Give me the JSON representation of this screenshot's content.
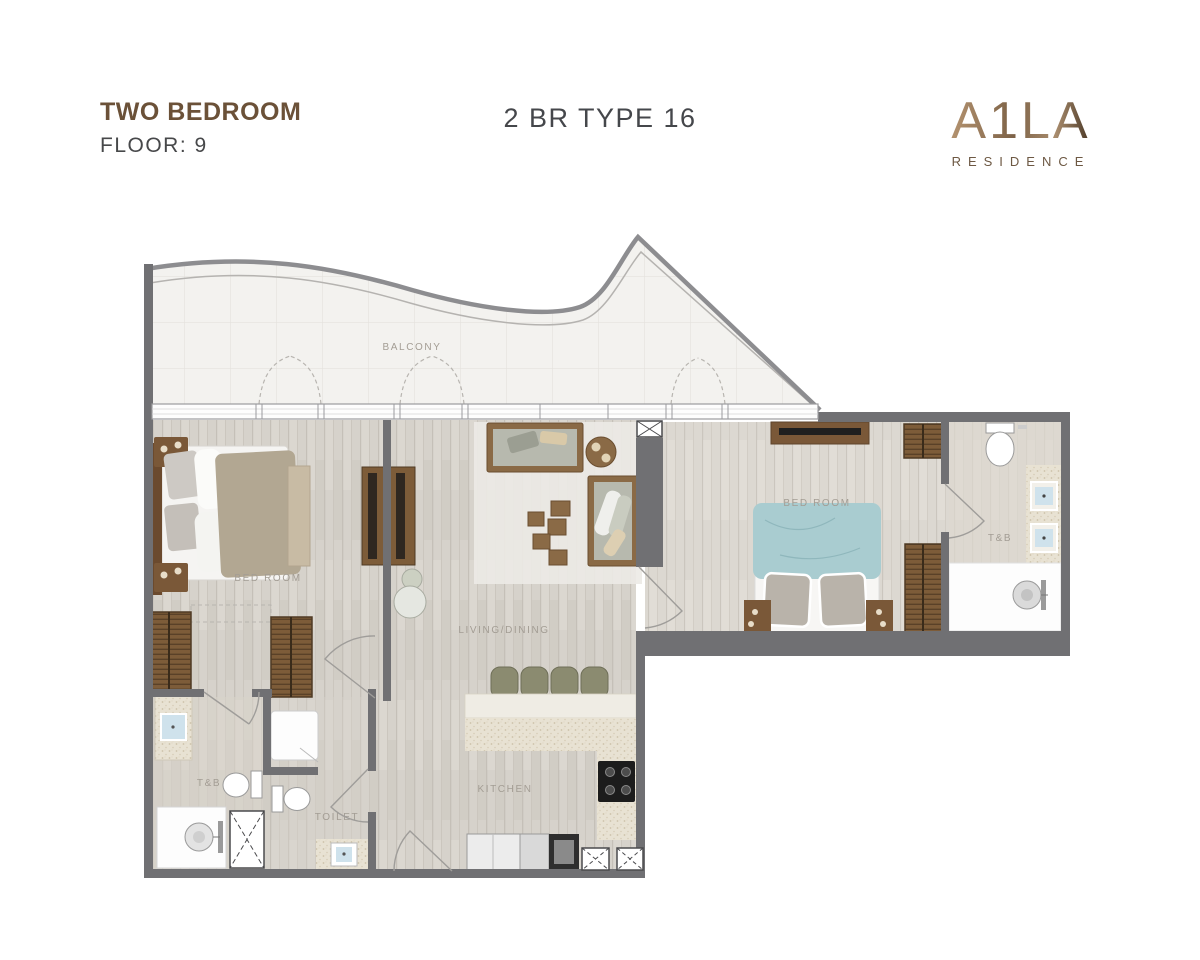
{
  "header": {
    "unit_type": "TWO BEDROOM",
    "floor": "FLOOR: 9",
    "plan_code": "2 BR TYPE 16",
    "logo_text": "A1LA",
    "logo_subtext": "RESIDENCE"
  },
  "labels": {
    "balcony": "BALCONY",
    "bedroom1": "BED ROOM",
    "bedroom2": "BED ROOM",
    "living_dining": "LIVING/DINING",
    "kitchen": "KITCHEN",
    "toilet": "TOILET",
    "tb_left": "T&B",
    "tb_right": "T&B"
  },
  "colors": {
    "wall": "#707073",
    "title_brown": "#6b5138",
    "code_gray": "#45474b",
    "wood_floor": "#d6d2cb",
    "balcony_tile": "#f3f2ef",
    "counter_speckle": "#e8e2d3",
    "closet_brown": "#7d5c39",
    "bed2_blanket": "#a9ccd0",
    "bed1_blanket": "#b2a792",
    "stool_olive": "#8b8b70"
  }
}
